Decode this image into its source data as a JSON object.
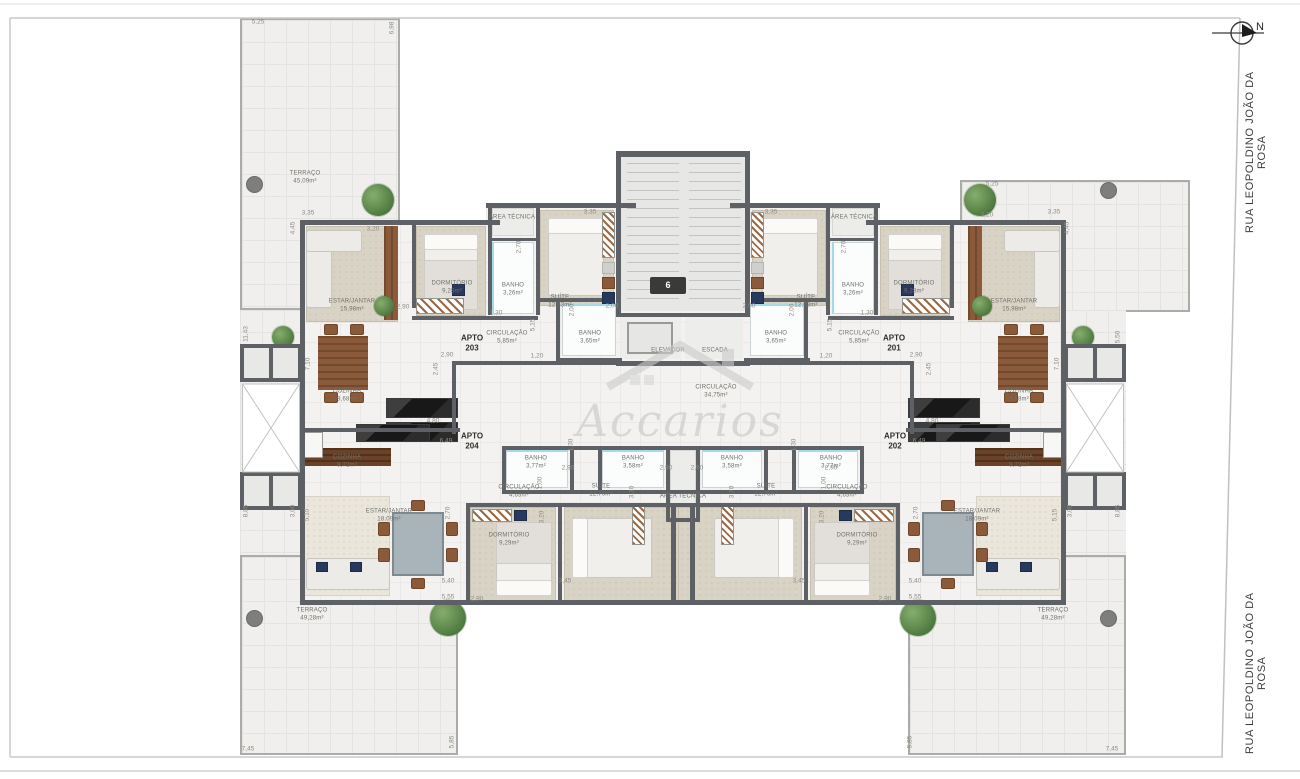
{
  "page": {
    "street_label": "RUA LEOPOLDINO JOÃO DA ROSA",
    "compass": "N",
    "watermark": "Accarios",
    "stair_sign": "6"
  },
  "apartment_labels": [
    {
      "label": "APTO",
      "number": "203",
      "x": 472,
      "y": 344
    },
    {
      "label": "APTO",
      "number": "201",
      "x": 894,
      "y": 344
    },
    {
      "label": "APTO",
      "number": "204",
      "x": 472,
      "y": 442
    },
    {
      "label": "APTO",
      "number": "202",
      "x": 895,
      "y": 442
    }
  ],
  "room_labels": [
    {
      "name": "TERRAÇO",
      "area": "45,09m²",
      "x": 305,
      "y": 178
    },
    {
      "name": "ESTAR/JANTAR",
      "area": "15,98m²",
      "x": 352,
      "y": 306
    },
    {
      "name": "DORMITÓRIO",
      "area": "9,28m²",
      "x": 452,
      "y": 288
    },
    {
      "name": "BANHO",
      "area": "3,26m²",
      "x": 513,
      "y": 290
    },
    {
      "name": "ÁREA TÉCNICA",
      "area": "",
      "x": 512,
      "y": 218
    },
    {
      "name": "SUÍTE",
      "area": "12,63m²",
      "x": 560,
      "y": 302
    },
    {
      "name": "BANHO",
      "area": "3,65m²",
      "x": 590,
      "y": 338
    },
    {
      "name": "CIRCULAÇÃO",
      "area": "5,85m²",
      "x": 507,
      "y": 338
    },
    {
      "name": "COZINHA",
      "area": "9,68m²",
      "x": 347,
      "y": 396
    },
    {
      "name": "ELEVADOR",
      "area": "",
      "x": 668,
      "y": 351
    },
    {
      "name": "ESCADA",
      "area": "",
      "x": 715,
      "y": 351
    },
    {
      "name": "CIRCULAÇÃO",
      "area": "34,75m²",
      "x": 716,
      "y": 392
    },
    {
      "name": "SUÍTE",
      "area": "12,63m²",
      "x": 806,
      "y": 302
    },
    {
      "name": "BANHO",
      "area": "3,26m²",
      "x": 853,
      "y": 290
    },
    {
      "name": "ÁREA TÉCNICA",
      "area": "",
      "x": 854,
      "y": 218
    },
    {
      "name": "DORMITÓRIO",
      "area": "9,28m²",
      "x": 914,
      "y": 288
    },
    {
      "name": "ESTAR/JANTAR",
      "area": "15,98m²",
      "x": 1014,
      "y": 306
    },
    {
      "name": "BANHO",
      "area": "3,65m²",
      "x": 776,
      "y": 338
    },
    {
      "name": "CIRCULAÇÃO",
      "area": "5,85m²",
      "x": 859,
      "y": 338
    },
    {
      "name": "COZINHA",
      "area": "9,68m²",
      "x": 1019,
      "y": 396
    },
    {
      "name": "COZINHA",
      "area": "9,72m²",
      "x": 347,
      "y": 462
    },
    {
      "name": "BANHO",
      "area": "3,77m²",
      "x": 536,
      "y": 463
    },
    {
      "name": "BANHO",
      "area": "3,58m²",
      "x": 633,
      "y": 463
    },
    {
      "name": "ÁREA TÉCNICA",
      "area": "",
      "x": 683,
      "y": 497
    },
    {
      "name": "CIRCULAÇÃO",
      "area": "4,63m²",
      "x": 519,
      "y": 492
    },
    {
      "name": "SUÍTE",
      "area": "12,76m²",
      "x": 601,
      "y": 491
    },
    {
      "name": "DORMITÓRIO",
      "area": "9,29m²",
      "x": 509,
      "y": 540
    },
    {
      "name": "ESTAR/JANTAR",
      "area": "18,09m²",
      "x": 389,
      "y": 516
    },
    {
      "name": "TERRAÇO",
      "area": "49,28m²",
      "x": 312,
      "y": 615
    },
    {
      "name": "BANHO",
      "area": "3,58m²",
      "x": 732,
      "y": 463
    },
    {
      "name": "BANHO",
      "area": "3,77m²",
      "x": 831,
      "y": 463
    },
    {
      "name": "CIRCULAÇÃO",
      "area": "4,63m²",
      "x": 847,
      "y": 492
    },
    {
      "name": "SUÍTE",
      "area": "12,76m²",
      "x": 766,
      "y": 491
    },
    {
      "name": "DORMITÓRIO",
      "area": "9,29m²",
      "x": 857,
      "y": 540
    },
    {
      "name": "ESTAR/JANTAR",
      "area": "18,09m²",
      "x": 977,
      "y": 516
    },
    {
      "name": "COZINHA",
      "area": "9,72m²",
      "x": 1019,
      "y": 462
    },
    {
      "name": "TERRAÇO",
      "area": "49,28m²",
      "x": 1053,
      "y": 615
    }
  ],
  "dimensions": [
    {
      "t": "5,25",
      "x": 258,
      "y": 22
    },
    {
      "t": "6,98",
      "x": 392,
      "y": 28,
      "r": 1
    },
    {
      "t": "3,35",
      "x": 308,
      "y": 213
    },
    {
      "t": "4,45",
      "x": 293,
      "y": 228,
      "r": 1
    },
    {
      "t": "3,20",
      "x": 373,
      "y": 229
    },
    {
      "t": "2,90",
      "x": 403,
      "y": 307
    },
    {
      "t": "3,35",
      "x": 590,
      "y": 212
    },
    {
      "t": "2,70",
      "x": 519,
      "y": 247,
      "r": 1
    },
    {
      "t": "2,00",
      "x": 612,
      "y": 306
    },
    {
      "t": "2,00",
      "x": 572,
      "y": 310,
      "r": 1
    },
    {
      "t": "1,30",
      "x": 496,
      "y": 313
    },
    {
      "t": "5,15",
      "x": 533,
      "y": 325,
      "r": 1
    },
    {
      "t": "1,20",
      "x": 537,
      "y": 356
    },
    {
      "t": "2,90",
      "x": 447,
      "y": 355
    },
    {
      "t": "2,45",
      "x": 436,
      "y": 369,
      "r": 1
    },
    {
      "t": "7,10",
      "x": 308,
      "y": 364,
      "r": 1
    },
    {
      "t": "11,43",
      "x": 246,
      "y": 334,
      "r": 1
    },
    {
      "t": "5,25",
      "x": 992,
      "y": 184
    },
    {
      "t": "3,35",
      "x": 1054,
      "y": 212
    },
    {
      "t": "4,45",
      "x": 1067,
      "y": 228,
      "r": 1
    },
    {
      "t": "3,20",
      "x": 987,
      "y": 215
    },
    {
      "t": "3,35",
      "x": 771,
      "y": 212
    },
    {
      "t": "2,70",
      "x": 844,
      "y": 247,
      "r": 1
    },
    {
      "t": "2,00",
      "x": 749,
      "y": 306
    },
    {
      "t": "2,00",
      "x": 792,
      "y": 310,
      "r": 1
    },
    {
      "t": "1,30",
      "x": 867,
      "y": 313
    },
    {
      "t": "5,15",
      "x": 830,
      "y": 325,
      "r": 1
    },
    {
      "t": "1,20",
      "x": 826,
      "y": 356
    },
    {
      "t": "2,90",
      "x": 916,
      "y": 355
    },
    {
      "t": "2,45",
      "x": 929,
      "y": 369,
      "r": 1
    },
    {
      "t": "7,10",
      "x": 1057,
      "y": 364,
      "r": 1
    },
    {
      "t": "5,50",
      "x": 1118,
      "y": 337,
      "r": 1
    },
    {
      "t": "8,85",
      "x": 246,
      "y": 511,
      "r": 1
    },
    {
      "t": "3,00",
      "x": 293,
      "y": 511,
      "r": 1
    },
    {
      "t": "5,15",
      "x": 307,
      "y": 515,
      "r": 1
    },
    {
      "t": "8,85",
      "x": 1118,
      "y": 511,
      "r": 1
    },
    {
      "t": "3,00",
      "x": 1070,
      "y": 511,
      "r": 1
    },
    {
      "t": "5,15",
      "x": 1055,
      "y": 515,
      "r": 1
    },
    {
      "t": "4,80",
      "x": 433,
      "y": 421
    },
    {
      "t": "6,49",
      "x": 446,
      "y": 441
    },
    {
      "t": "4,80",
      "x": 932,
      "y": 421
    },
    {
      "t": "6,49",
      "x": 919,
      "y": 441
    },
    {
      "t": "2,90",
      "x": 568,
      "y": 468
    },
    {
      "t": "2,90",
      "x": 666,
      "y": 468
    },
    {
      "t": "2,90",
      "x": 697,
      "y": 468
    },
    {
      "t": "2,90",
      "x": 831,
      "y": 468
    },
    {
      "t": "1,30",
      "x": 571,
      "y": 445,
      "r": 1
    },
    {
      "t": "1,30",
      "x": 794,
      "y": 445,
      "r": 1
    },
    {
      "t": "1,00",
      "x": 540,
      "y": 483,
      "r": 1
    },
    {
      "t": "1,00",
      "x": 824,
      "y": 483,
      "r": 1
    },
    {
      "t": "3,20",
      "x": 542,
      "y": 517,
      "r": 1
    },
    {
      "t": "3,20",
      "x": 822,
      "y": 517,
      "r": 1
    },
    {
      "t": "3,70",
      "x": 632,
      "y": 492,
      "r": 1
    },
    {
      "t": "3,70",
      "x": 732,
      "y": 492,
      "r": 1
    },
    {
      "t": "2,70",
      "x": 448,
      "y": 513,
      "r": 1
    },
    {
      "t": "2,70",
      "x": 916,
      "y": 513,
      "r": 1
    },
    {
      "t": "5,40",
      "x": 448,
      "y": 581
    },
    {
      "t": "5,55",
      "x": 448,
      "y": 597
    },
    {
      "t": "5,40",
      "x": 915,
      "y": 581
    },
    {
      "t": "5,55",
      "x": 915,
      "y": 597
    },
    {
      "t": "2,90",
      "x": 477,
      "y": 599
    },
    {
      "t": "2,90",
      "x": 885,
      "y": 599
    },
    {
      "t": "3,45",
      "x": 565,
      "y": 581
    },
    {
      "t": "3,45",
      "x": 799,
      "y": 581
    },
    {
      "t": "7,45",
      "x": 248,
      "y": 749
    },
    {
      "t": "5,85",
      "x": 452,
      "y": 742,
      "r": 1
    },
    {
      "t": "7,45",
      "x": 1112,
      "y": 749
    },
    {
      "t": "5,85",
      "x": 910,
      "y": 742,
      "r": 1
    }
  ]
}
